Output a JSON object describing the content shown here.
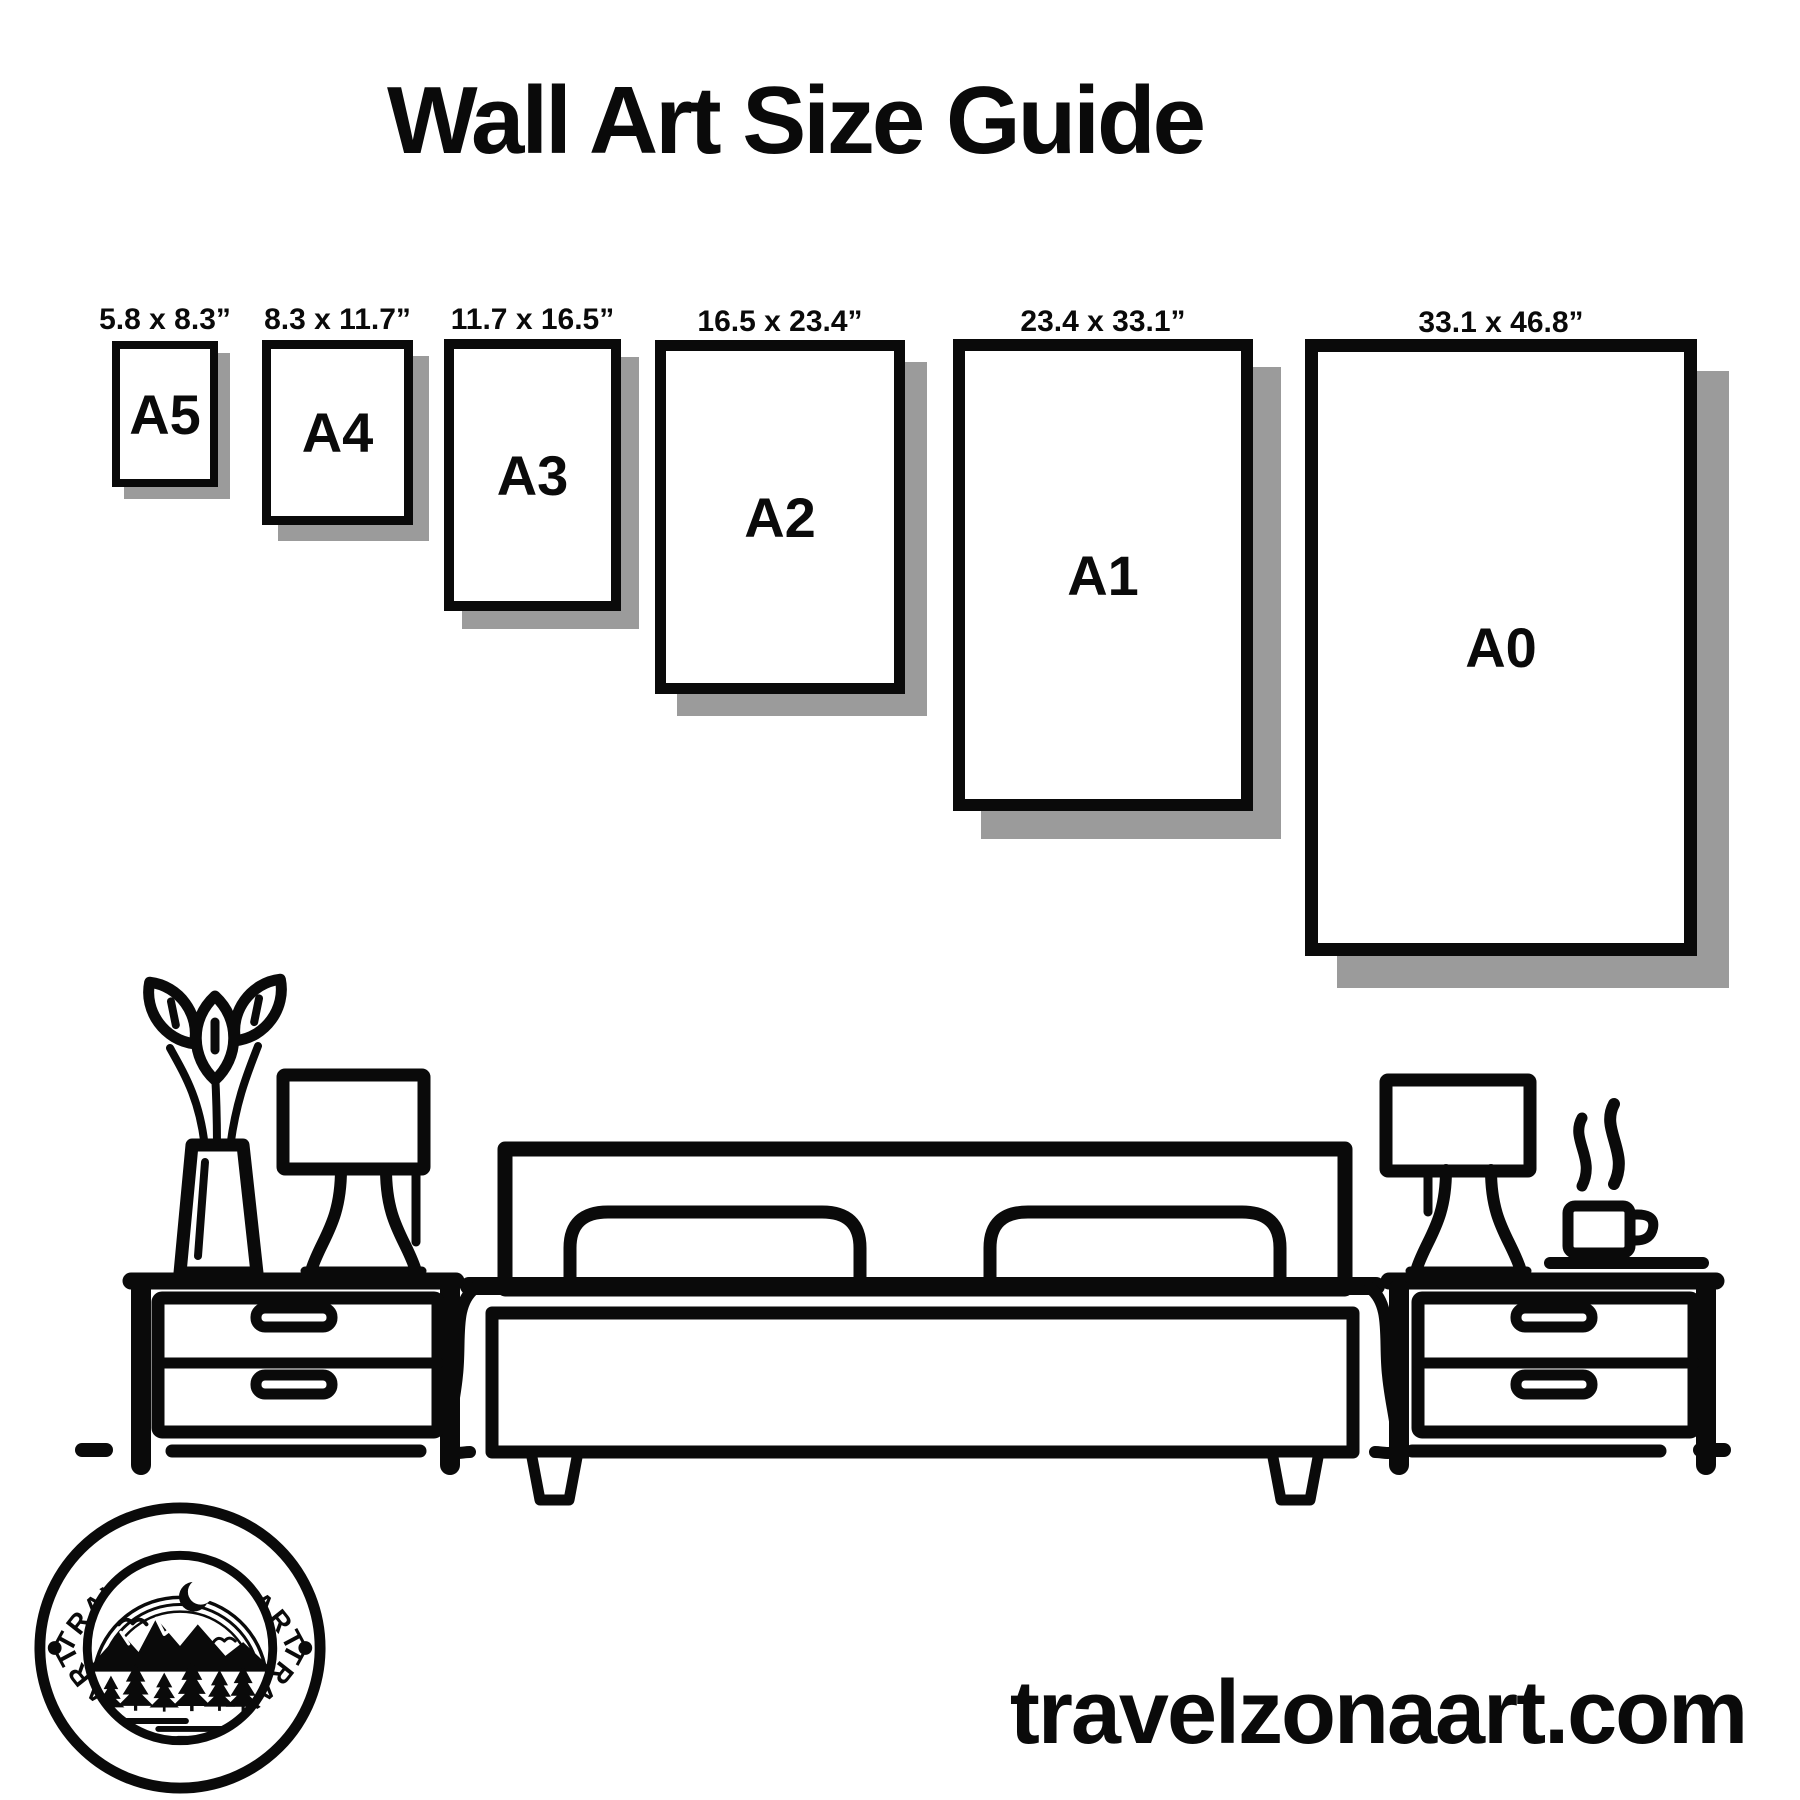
{
  "title": "Wall Art Size Guide",
  "frames": [
    {
      "name": "A5",
      "dimensions": "5.8 x 8.3”"
    },
    {
      "name": "A4",
      "dimensions": "8.3 x 11.7”"
    },
    {
      "name": "A3",
      "dimensions": "11.7 x 16.5”"
    },
    {
      "name": "A2",
      "dimensions": "16.5 x 23.4”"
    },
    {
      "name": "A1",
      "dimensions": "23.4 x 33.1”"
    },
    {
      "name": "A0",
      "dimensions": "33.1 x 46.8”"
    }
  ],
  "logo": {
    "arc_text_top": "TRAVELZONAART",
    "arc_text_bottom": "TRAVELZONAART"
  },
  "website": "travelzonaart.com",
  "colors": {
    "ink": "#0a0a0a",
    "shadow": "#9b9b9b",
    "background": "#ffffff"
  },
  "scene_icons": [
    "plant-vase-icon",
    "table-lamp-icon",
    "bed-icon",
    "nightstand-icon",
    "coffee-cup-icon",
    "steam-icon",
    "moon-icon",
    "mountains-icon",
    "pine-tree-icon"
  ]
}
